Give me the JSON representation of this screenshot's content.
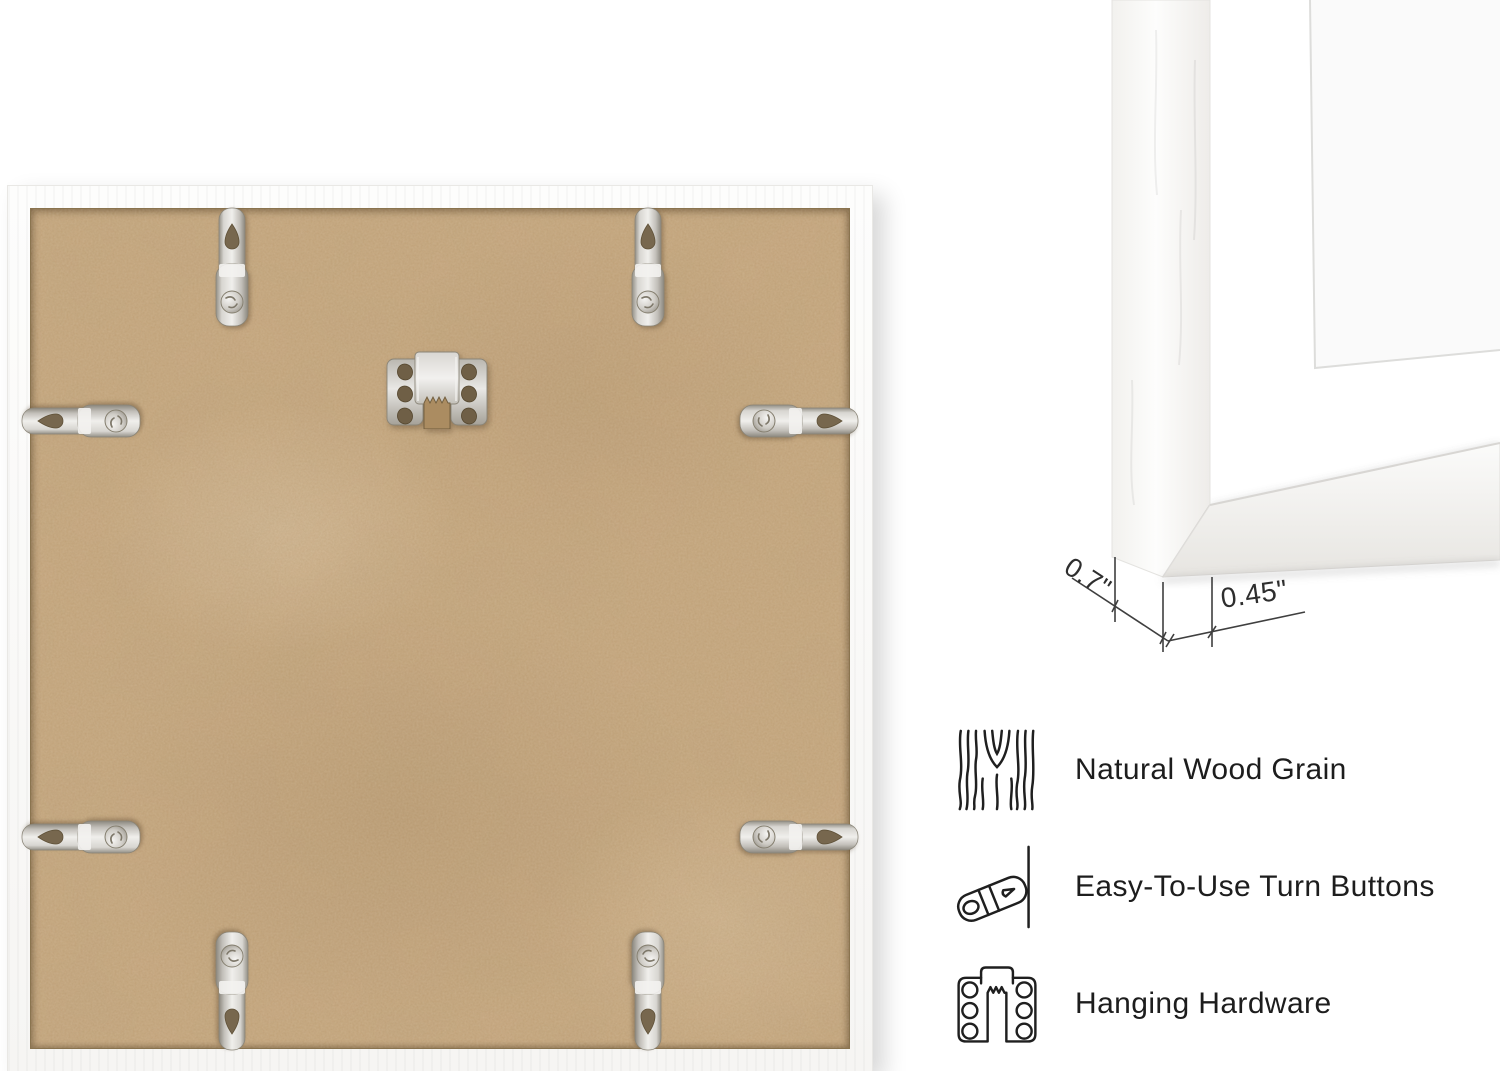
{
  "colors": {
    "background": "#ffffff",
    "backing_board": "#c7a67c",
    "frame_white": "#fdfdfc",
    "hardware_metal": "#d6d4cf",
    "line_art": "#1f1f1f",
    "annotation_lines": "#3f3f3f"
  },
  "dimension_annotations": {
    "frame_depth": "0.7\"",
    "frame_face_width": "0.45\""
  },
  "features": [
    {
      "icon": "wood-grain-icon",
      "label": "Natural Wood Grain"
    },
    {
      "icon": "turn-button-icon",
      "label": "Easy-To-Use Turn Buttons"
    },
    {
      "icon": "hanging-hardware-icon",
      "label": "Hanging Hardware"
    }
  ],
  "back_view": {
    "turn_button_count": 8,
    "sawtooth_hanger_count": 1
  }
}
